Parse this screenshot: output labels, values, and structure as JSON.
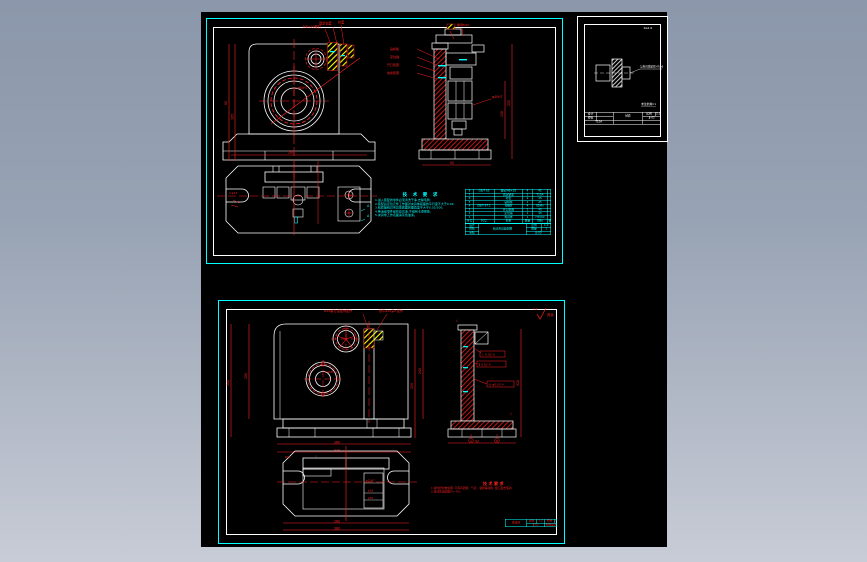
{
  "viewer": {
    "background_top": "#8b97aa",
    "background_bottom": "#c8ccd6",
    "canvas_color": "#000000"
  },
  "palette": {
    "cyan": "#00ffff",
    "red": "#ff0000",
    "white": "#ffffff",
    "yellow": "#ffff00"
  },
  "sheet1": {
    "notes": {
      "title": "技 术 要 求",
      "lines": [
        "1.进入装配的零件必须清洗干净,去除毛刺;",
        "2.装配后定位元件工作面对夹具体底面的平行度不大于0.02;",
        "3.钻套轴线对夹具体底面的垂直度不大于0.02/100;",
        "4.各活动零件动作应灵活,不得有卡滞现象;",
        "5.夹具非工作表面涂灰色油漆。"
      ]
    },
    "front_callouts": [
      "M8×20螺钉",
      "固定钻套",
      "衬套"
    ],
    "side_callouts": [
      "钻模板",
      "定位轴",
      "开口垫圈",
      "快换垫圈",
      "螺母M10"
    ],
    "section_marks": [
      "A",
      "A"
    ],
    "dims": {
      "d1": "80",
      "d2": "105",
      "d3": "260",
      "d4": "2-φ13",
      "d5": "255",
      "d6": "118",
      "d7": "92",
      "d8": "φ40H7",
      "d9": "φ62H7"
    },
    "bom": {
      "headers": [
        "序号",
        "代号",
        "名称",
        "数量",
        "材料",
        "备注"
      ],
      "rows": [
        [
          "8",
          "GB/T 65",
          "螺钉M8×25",
          "4",
          "45",
          ""
        ],
        [
          "7",
          "",
          "固定钻套",
          "2",
          "T10A",
          ""
        ],
        [
          "6",
          "",
          "衬套",
          "2",
          "45",
          ""
        ],
        [
          "5",
          "",
          "钻模板",
          "1",
          "45",
          ""
        ],
        [
          "4",
          "GB/T 97.1",
          "垫圈8",
          "4",
          "65Mn",
          ""
        ],
        [
          "3",
          "",
          "开口垫圈",
          "1",
          "45",
          ""
        ],
        [
          "2",
          "",
          "定位轴",
          "1",
          "45",
          ""
        ],
        [
          "1",
          "",
          "夹具体",
          "1",
          "HT200",
          ""
        ]
      ]
    },
    "tb": {
      "design": "设计",
      "check": "校核",
      "audit": "审核",
      "name": "钻床夹具装配图",
      "scale_label": "比例",
      "scale": "1:2",
      "qty_label": "数量",
      "qty": "1",
      "no": "JJ-00"
    }
  },
  "detail_sheet": {
    "corner": "Ra1.6",
    "callout": "与夹具体配作H7/n6",
    "note": "未注倒角C1",
    "tb": {
      "design": "设计",
      "check": "校核",
      "name": "钻套",
      "material": "T10A",
      "scale_label": "比例",
      "scale": "2:1",
      "no": "JJ-02"
    }
  },
  "sheet2": {
    "corner": "其余",
    "corner_value": "3.2",
    "finish": "√",
    "top_callouts": [
      "M12螺孔 装配时配作",
      "锪平φ24深2 配作"
    ],
    "gdt": [
      "⊥ 0.02 A",
      "∥ 0.02 A",
      "◎ φ0.03 A"
    ],
    "datums": [
      "A",
      "B"
    ],
    "notes": {
      "title": "技术要求",
      "lines": [
        "1.铸件经时效处理, 不得有砂眼、气孔、裂纹等缺陷, 加工面去毛刺;",
        "2.未注铸造圆角R3~R5。"
      ]
    },
    "dims": {
      "l1": "240",
      "l2": "200",
      "m1": "255",
      "m2": "240",
      "b1": "260",
      "b2": "320",
      "s1": "320",
      "s2": "92",
      "v1": "260",
      "v2": "380",
      "h1": "φ12H7",
      "h2": "φ18",
      "h3": "φ30",
      "t1": "R15",
      "c1": "φ40H7"
    },
    "tb": {
      "name": "夹具体",
      "scale_label": "比例",
      "scale": "1:2",
      "mat_label": "材料",
      "material": "HT200",
      "no": "JJ-01",
      "school": "机械设计课程设计"
    }
  }
}
